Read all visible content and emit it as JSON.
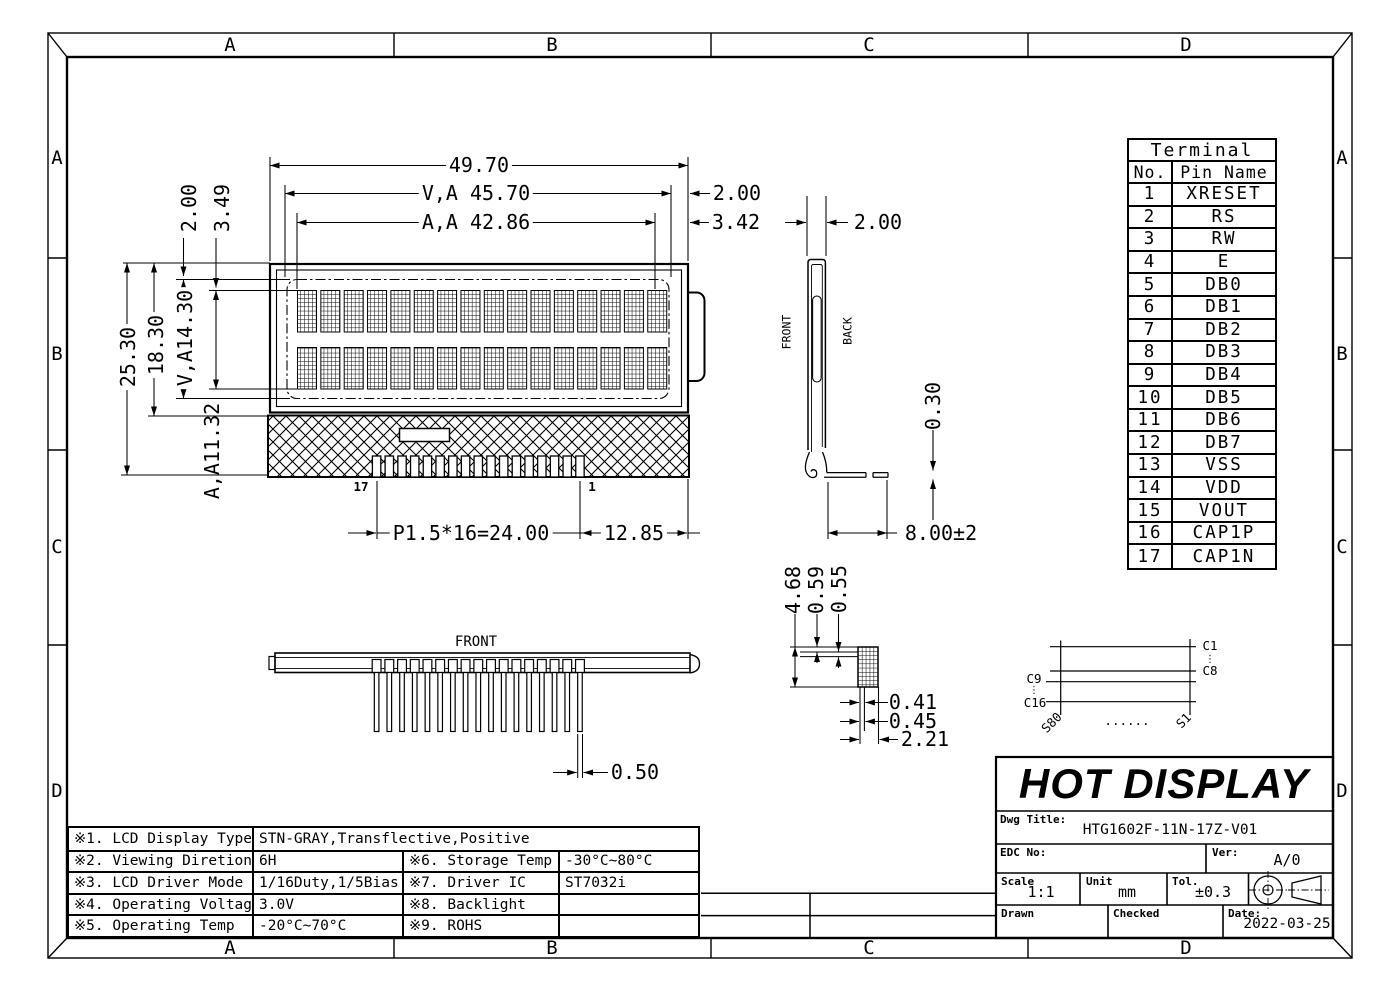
{
  "zones": {
    "top": [
      "A",
      "B",
      "C",
      "D"
    ],
    "bottom": [
      "A",
      "B",
      "C",
      "D"
    ],
    "left": [
      "A",
      "B",
      "C",
      "D"
    ],
    "right": [
      "A",
      "B",
      "C",
      "D"
    ]
  },
  "terminal_table": {
    "title": "Terminal",
    "headers": [
      "No.",
      "Pin Name"
    ],
    "rows": [
      [
        "1",
        "XRESET"
      ],
      [
        "2",
        "RS"
      ],
      [
        "3",
        "RW"
      ],
      [
        "4",
        "E"
      ],
      [
        "5",
        "DB0"
      ],
      [
        "6",
        "DB1"
      ],
      [
        "7",
        "DB2"
      ],
      [
        "8",
        "DB3"
      ],
      [
        "9",
        "DB4"
      ],
      [
        "10",
        "DB5"
      ],
      [
        "11",
        "DB6"
      ],
      [
        "12",
        "DB7"
      ],
      [
        "13",
        "VSS"
      ],
      [
        "14",
        "VDD"
      ],
      [
        "15",
        "VOUT"
      ],
      [
        "16",
        "CAP1P"
      ],
      [
        "17",
        "CAP1N"
      ]
    ]
  },
  "spec_table": {
    "row1": {
      "label": "※1. LCD Display Type",
      "value": "STN-GRAY,Transflective,Positive"
    },
    "rows": [
      {
        "l1": "※2. Viewing Diretion",
        "v1": "6H",
        "l2": "※6. Storage Temp",
        "v2": "-30°C~80°C"
      },
      {
        "l1": "※3. LCD Driver Mode",
        "v1": "1/16Duty,1/5Bias",
        "l2": "※7. Driver IC",
        "v2": "ST7032i"
      },
      {
        "l1": "※4. Operating Voltage",
        "v1": "3.0V",
        "l2": "※8. Backlight",
        "v2": ""
      },
      {
        "l1": "※5. Operating Temp",
        "v1": "-20°C~70°C",
        "l2": "※9. ROHS",
        "v2": ""
      }
    ]
  },
  "title_block": {
    "company": "HOT DISPLAY",
    "dwg_title_label": "Dwg Title:",
    "dwg_title": "HTG1602F-11N-17Z-V01",
    "edc_label": "EDC No:",
    "ver_label": "Ver:",
    "ver_value": "A/0",
    "scale_label": "Scale",
    "scale_value": "1:1",
    "unit_label": "Unit",
    "unit_value": "mm",
    "tol_label": "Tol.",
    "tol_value": "±0.3",
    "drawn_label": "Drawn",
    "checked_label": "Checked",
    "date_label": "Date:",
    "date_value": "2022-03-25"
  },
  "dims": {
    "overall_width": "49.70",
    "va_width": "V,A 45.70",
    "va_width_offset": "2.00",
    "aa_width": "A,A 42.86",
    "aa_width_offset": "3.42",
    "overall_height": "25.30",
    "display_height": "18.30",
    "va_height": "V,A14.30",
    "aa_height": "A,A11.32",
    "va_top_offset": "2.00",
    "aa_top_offset": "3.49",
    "pin_pitch": "P1.5*16=24.00",
    "pin_right": "12.85",
    "pin_last": "17",
    "pin_first": "1",
    "side_thickness": "2.00",
    "tail_thickness": "0.30",
    "tail_length": "8.00±2",
    "pin_width": "0.50",
    "stack_height": "4.68",
    "stack_t1": "0.59",
    "stack_t2": "0.55",
    "stack_w1": "0.41",
    "stack_w2": "0.45",
    "stack_width": "2.21"
  },
  "labels": {
    "front_side": "FRONT",
    "back_side": "BACK",
    "front_bottom": "FRONT"
  },
  "connector": {
    "c1": "C1",
    "c8": "C8",
    "c9": "C9",
    "c16": "C16",
    "s80": "S80",
    "s1": "S1",
    "vdots": "⋮",
    "hdots": "......"
  }
}
